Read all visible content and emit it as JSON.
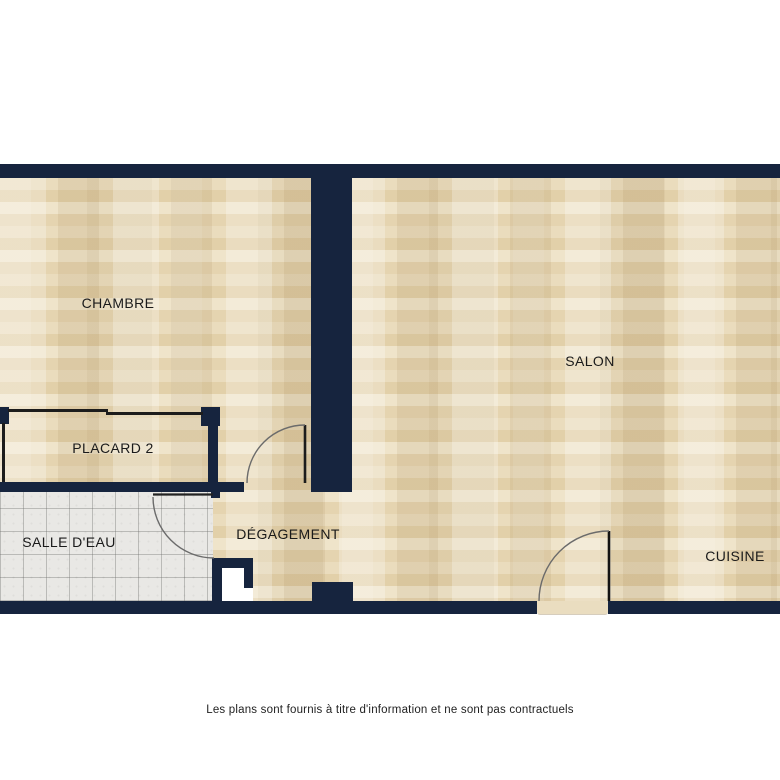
{
  "palette": {
    "wall": "#16243e",
    "wood_base": "#e8d7b4",
    "tile_base": "#e9e8e5",
    "thin_line": "#1c1c1c",
    "door_arc": "#6b6b6b",
    "label_text": "#1a1a1a",
    "background": "#ffffff"
  },
  "floor_plan": {
    "rooms": [
      {
        "id": "chambre",
        "label": "CHAMBRE",
        "floor": "wood"
      },
      {
        "id": "salon",
        "label": "SALON",
        "floor": "wood"
      },
      {
        "id": "placard-2",
        "label": "PLACARD 2",
        "floor": "wood"
      },
      {
        "id": "salle-deau",
        "label": "SALLE D'EAU",
        "floor": "tile"
      },
      {
        "id": "degagement",
        "label": "DÉGAGEMENT",
        "floor": "wood"
      },
      {
        "id": "cuisine",
        "label": "CUISINE",
        "floor": "wood"
      }
    ],
    "doors": [
      {
        "id": "door-salle-deau",
        "type": "swing-door"
      },
      {
        "id": "door-chambre",
        "type": "swing-door"
      },
      {
        "id": "door-entry",
        "type": "swing-door"
      }
    ],
    "disclaimer": "Les plans sont fournis à titre d'information et ne sont pas contractuels"
  }
}
